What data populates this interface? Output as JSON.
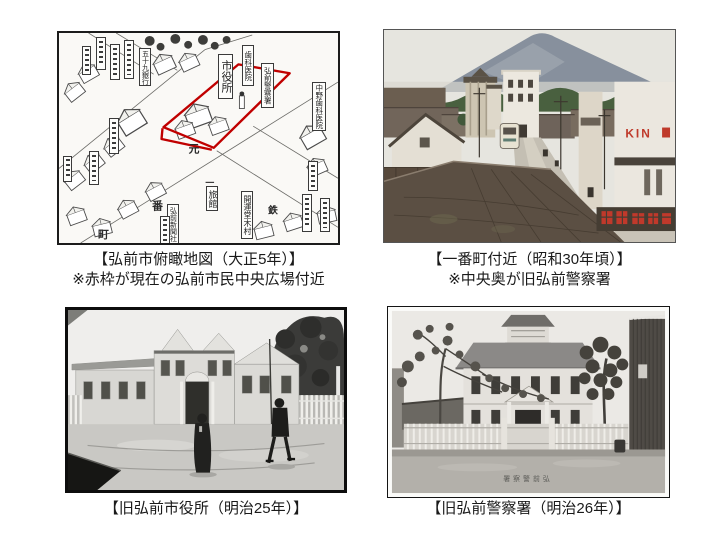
{
  "slide": {
    "background": "#ffffff",
    "map_panel": {
      "caption_line1": "【弘前市俯瞰地図（大正5年）】",
      "caption_line2": "※赤枠が現在の弘前市民中央広場付近",
      "red_frame_color": "#c00000",
      "labels": {
        "city_hall": "市役所",
        "police_station": "弘前警察署",
        "dental_clinic": "歯科医院",
        "nakano_dental": "中野歯科医院",
        "bank_59": "五十九銀行",
        "newspaper": "弘前新聞社",
        "kaiundo": "開運堂木村",
        "ryokan": "旅館"
      },
      "street_chars": {
        "ichi": "一",
        "ban": "番",
        "cho": "町",
        "moto": "元",
        "tetsu": "鉄"
      }
    },
    "street_photo_panel": {
      "caption_line1": "【一番町付近（昭和30年頃）】",
      "caption_line2": "※中央奥が旧弘前警察署",
      "storefront_sign": "KIN"
    },
    "city_hall_panel": {
      "caption": "【旧弘前市役所（明治25年）】"
    },
    "police_panel": {
      "caption": "【旧弘前警察署（明治26年）】",
      "photo_caption": "署察警前弘"
    }
  }
}
